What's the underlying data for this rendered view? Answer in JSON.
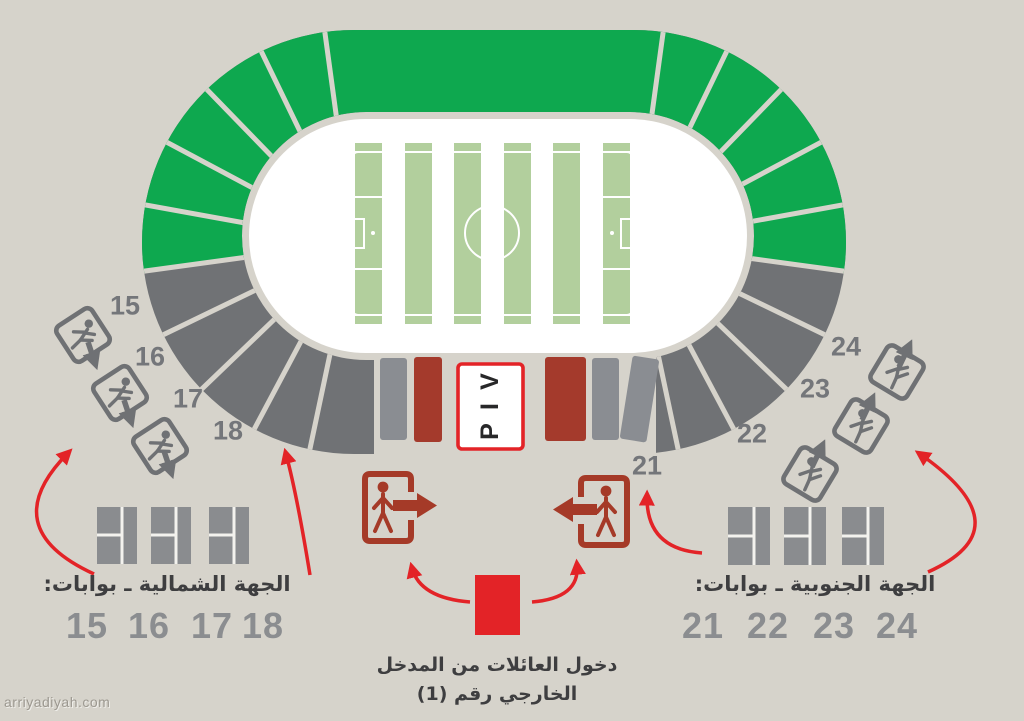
{
  "colors": {
    "background": "#d6d3cb",
    "stand_green": "#0ea84f",
    "stand_gray": "#707275",
    "bar_gray": "#8a8d92",
    "bar_dark_red": "#a43a2c",
    "bright_red": "#e32327",
    "pitch_stripe_green": "#b2cf9d",
    "number_gray": "#8b8d90",
    "text_dark": "#3e3e40",
    "white": "#ffffff"
  },
  "vip": {
    "letters": [
      "V",
      "I",
      "P"
    ]
  },
  "north_side": {
    "label": "الجهة الشمالية ـ بوابات:",
    "gates": [
      "15",
      "16",
      "17",
      "18"
    ]
  },
  "south_side": {
    "label": "الجهة الجنوبية ـ بوابات:",
    "gates": [
      "21",
      "22",
      "23",
      "24"
    ]
  },
  "family_entrance": {
    "line1": "دخول العائلات من المدخل",
    "line2": "الخارجي رقم (1)"
  },
  "watermark": "arriyadiyah.com",
  "icons": {
    "exit_gate": "running-man-exit-icon",
    "entry_right": "door-entry-arrow-right-icon",
    "entry_left": "door-entry-arrow-left-icon",
    "flow": "red-curved-arrow"
  }
}
